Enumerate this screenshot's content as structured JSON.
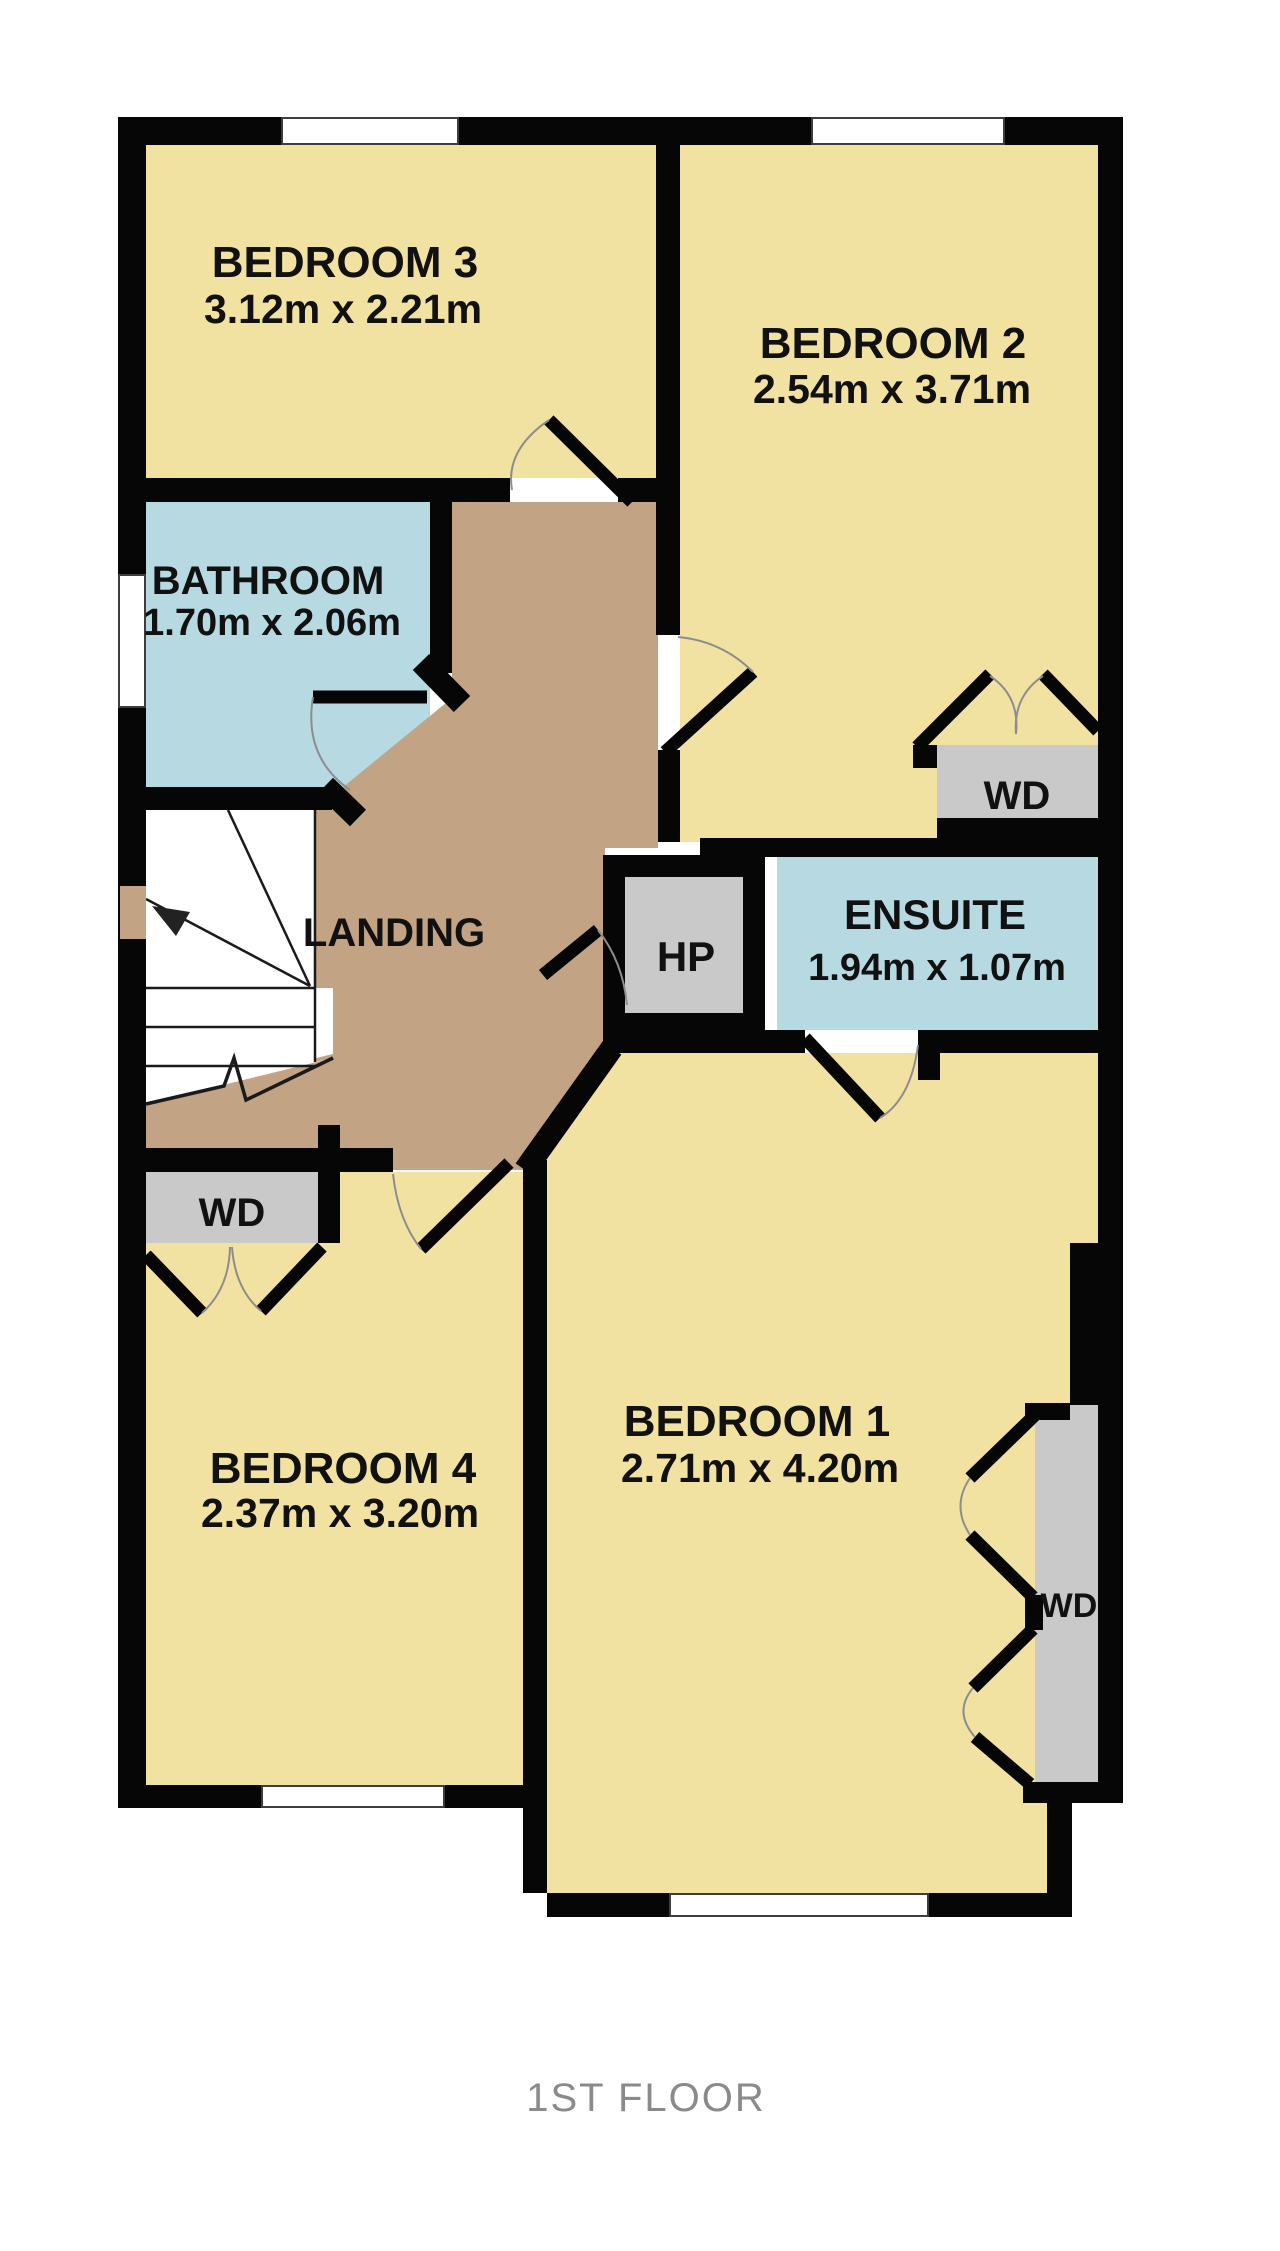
{
  "floor_plan": {
    "title": "1ST FLOOR",
    "rooms": {
      "bedroom3": {
        "name": "BEDROOM 3",
        "dims": "3.12m x 2.21m"
      },
      "bedroom2": {
        "name": "BEDROOM 2",
        "dims": "2.54m x 3.71m"
      },
      "bathroom": {
        "name": "BATHROOM",
        "dims": "1.70m x 2.06m"
      },
      "landing": {
        "name": "LANDING"
      },
      "ensuite": {
        "name": "ENSUITE",
        "dims": "1.94m x 1.07m"
      },
      "bedroom1": {
        "name": "BEDROOM 1",
        "dims": "2.71m x 4.20m"
      },
      "bedroom4": {
        "name": "BEDROOM 4",
        "dims": "2.37m x 3.20m"
      }
    },
    "features": {
      "wardrobe": "WD",
      "hot_press": "HP"
    },
    "colors": {
      "room_fill": "#f2e2a2",
      "landing_fill": "#c2a384",
      "wet_room_fill": "#b7d9e2",
      "closet_fill": "#c9c9c9",
      "wall": "#060606",
      "title_text": "#8a8a8a"
    }
  }
}
